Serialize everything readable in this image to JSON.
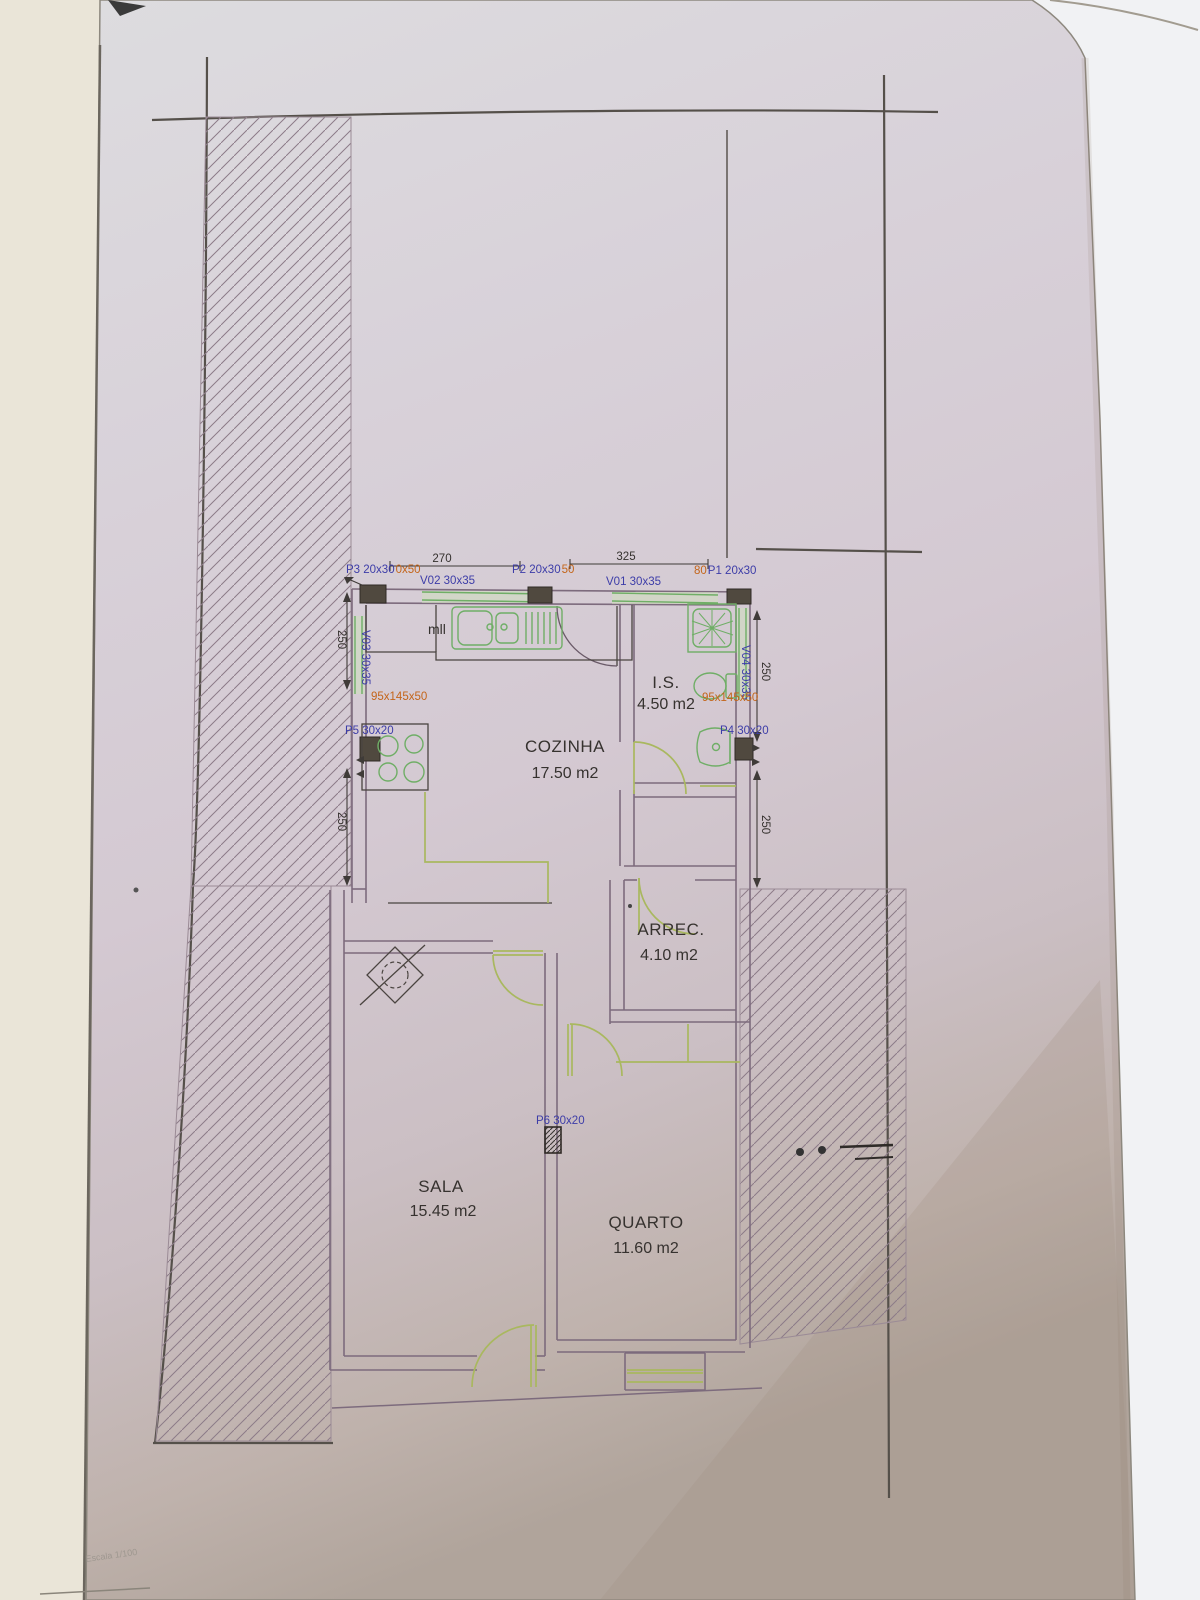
{
  "sheet": {
    "scale_text": "Escala 1/100"
  },
  "rooms": [
    {
      "name": "COZINHA",
      "area": "17.50 m2"
    },
    {
      "name": "I.S.",
      "area": "4.50 m2"
    },
    {
      "name": "ARREC.",
      "area": "4.10 m2"
    },
    {
      "name": "SALA",
      "area": "15.45 m2"
    },
    {
      "name": "QUARTO",
      "area": "11.60 m2"
    }
  ],
  "doors": {
    "p1": {
      "prefix": "80",
      "label": "P1 20x30"
    },
    "p2": {
      "label": "P2 20x30",
      "suffix": "50"
    },
    "p3": {
      "label": "P3 20x30",
      "suffix": "0x50"
    },
    "p4": {
      "label": "P4 30x20"
    },
    "p5": {
      "label": "P5 30x20"
    },
    "p6": {
      "label": "P6 30x20"
    }
  },
  "windows": {
    "v01": {
      "label": "V01 30x35"
    },
    "v02": {
      "label": "V02 30x35"
    },
    "v03": {
      "label": "V03 30x35"
    },
    "v04": {
      "label": "V04 30x35"
    }
  },
  "fixtures": {
    "left_note": "95x145x50",
    "right_note": "95x145x50",
    "counter_text": "mll"
  },
  "dimensions": {
    "top_left": "270",
    "top_right": "325",
    "left_upper": "250",
    "left_lower": "250",
    "right_upper": "250",
    "right_lower": "250"
  },
  "colors": {
    "wall": "#7d6b7d",
    "fixture_green": "#6fae66",
    "door_olive": "#a9b85f",
    "label_blue": "#3d3da8",
    "label_orange": "#c4651a",
    "ink": "#36322f"
  }
}
